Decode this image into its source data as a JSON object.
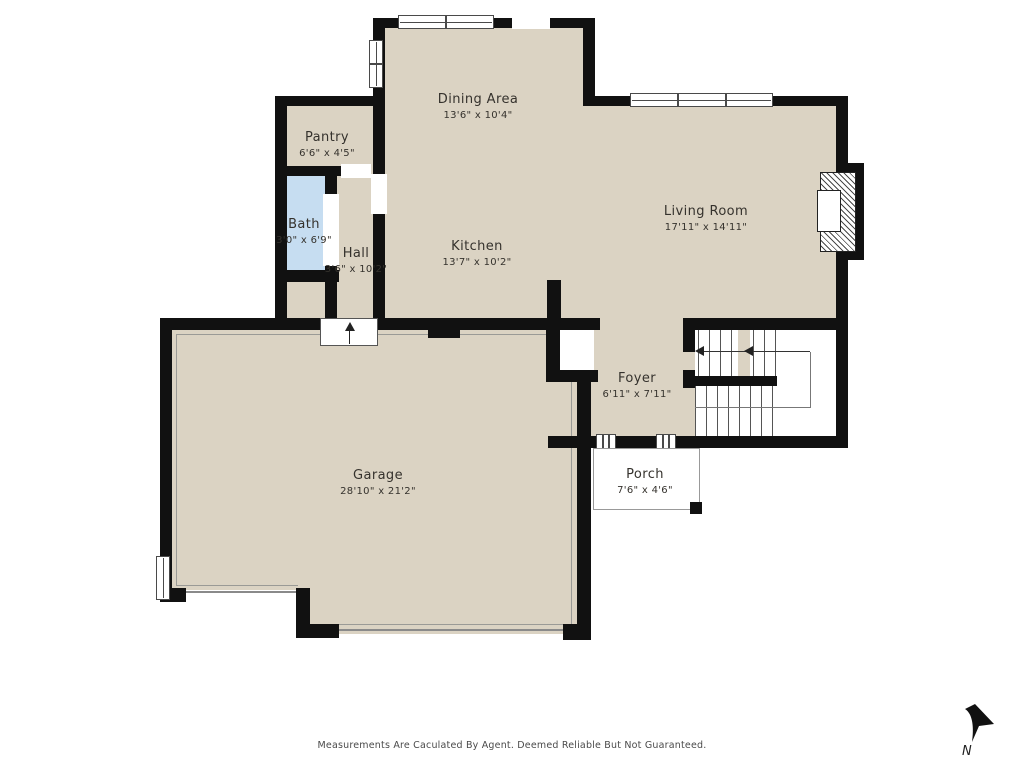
{
  "plan": {
    "rooms": [
      {
        "name": "Dining Area",
        "dims": "13'6\" x 10'4\""
      },
      {
        "name": "Pantry",
        "dims": "6'6\" x 4'5\""
      },
      {
        "name": "Bath",
        "dims": "3'0\" x 6'9\""
      },
      {
        "name": "Hall",
        "dims": "3'6\" x 10'2\""
      },
      {
        "name": "Kitchen",
        "dims": "13'7\" x 10'2\""
      },
      {
        "name": "Living Room",
        "dims": "17'11\" x 14'11\""
      },
      {
        "name": "Foyer",
        "dims": "6'11\" x 7'11\""
      },
      {
        "name": "Garage",
        "dims": "28'10\" x 21'2\""
      },
      {
        "name": "Porch",
        "dims": "7'6\" x 4'6\""
      }
    ],
    "colors": {
      "floor": "#dbd3c3",
      "bath": "#c6ddf1",
      "wall": "#111111",
      "background": "#ffffff"
    },
    "compass": {
      "label": "N"
    },
    "disclaimer": "Measurements Are Caculated By Agent. Deemed Reliable But Not Guaranteed."
  }
}
